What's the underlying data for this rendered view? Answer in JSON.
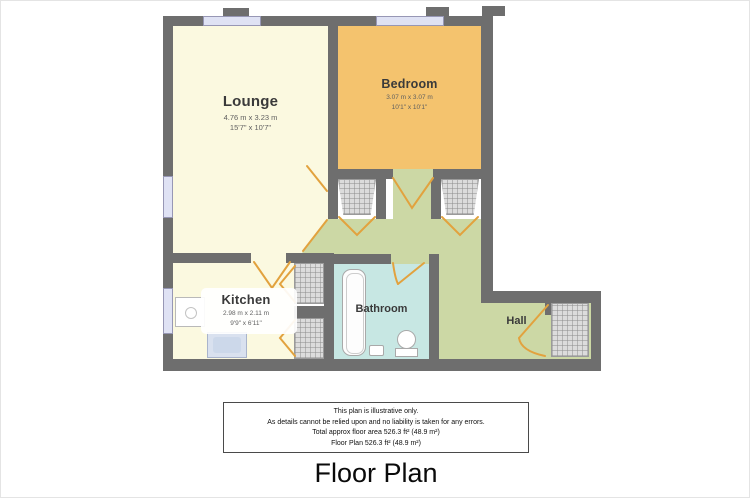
{
  "title": "Floor Plan",
  "plan": {
    "rooms": {
      "lounge": {
        "name": "Lounge",
        "metric": "4.76 m x 3.23 m",
        "imperial": "15'7\" x 10'7\""
      },
      "bedroom": {
        "name": "Bedroom",
        "metric": "3.07 m x 3.07 m",
        "imperial": "10'1\" x 10'1\""
      },
      "kitchen": {
        "name": "Kitchen",
        "metric": "2.98 m x 2.11 m",
        "imperial": "9'9\" x 6'11\""
      },
      "bathroom": {
        "name": "Bathroom"
      },
      "hall": {
        "name": "Hall"
      }
    },
    "colors": {
      "wall": "#6e6e6e",
      "lounge_fill": "#fbf9e0",
      "bedroom_fill": "#f4c36e",
      "kitchen_fill": "#fbf9e0",
      "bathroom_fill": "#c7e7e3",
      "hall_fill": "#ccd8a5",
      "window": "#dfe2f4",
      "door": "#e2a23e",
      "closet_fill": "#dcdcdc"
    }
  },
  "disclaimer": {
    "lines": [
      "This plan is illustrative only.",
      "As details cannot be relied upon and no liability is taken for any errors.",
      "Total approx floor area 526.3 ft² (48.9 m²)",
      "Floor Plan 526.3 ft² (48.9 m²)"
    ]
  }
}
